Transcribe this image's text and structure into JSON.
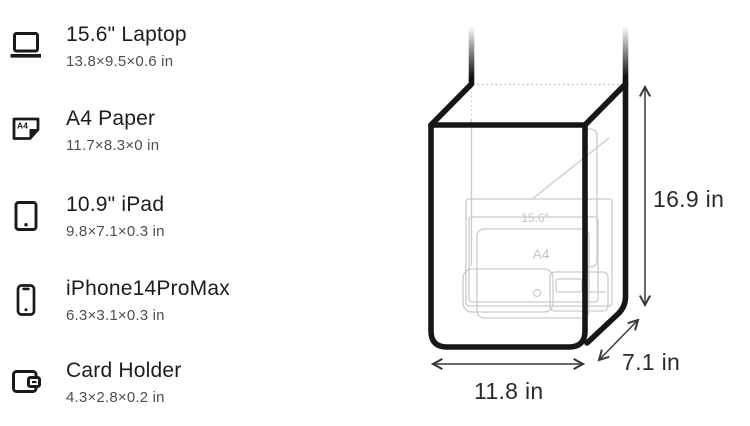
{
  "items": [
    {
      "name": "15.6\" Laptop",
      "dims": "13.8×9.5×0.6 in"
    },
    {
      "name": "A4 Paper",
      "dims": "11.7×8.3×0 in"
    },
    {
      "name": "10.9\" iPad",
      "dims": "9.8×7.1×0.3 in"
    },
    {
      "name": "iPhone14ProMax",
      "dims": "6.3×3.1×0.3 in"
    },
    {
      "name": "Card Holder",
      "dims": "4.3×2.8×0.2 in"
    }
  ],
  "icons": {
    "a4_label": "A4"
  },
  "diagram": {
    "height_label": "16.9 in",
    "width_label": "11.8 in",
    "depth_label": "7.1 in",
    "inner_labels": {
      "laptop": "15.6\"",
      "a4": "A4"
    },
    "colors": {
      "bag_outline": "#161616",
      "dimension_lines": "#3a3a3a",
      "faint_items": "#cbcbcb",
      "label_text": "#2b2b2b",
      "subtitle_text": "#4f4f4f"
    }
  }
}
